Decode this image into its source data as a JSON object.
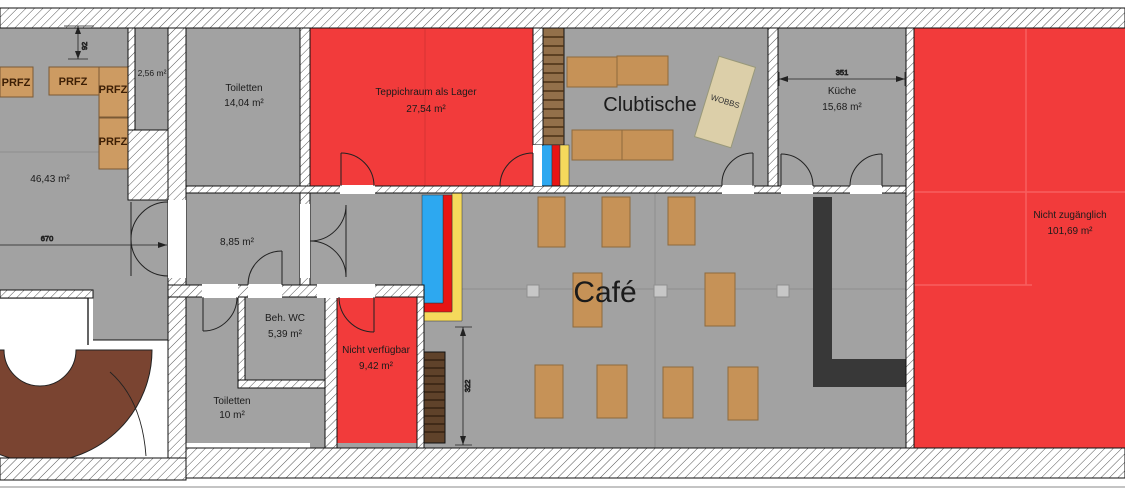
{
  "rooms": {
    "room_46": {
      "area": "46,43 m²"
    },
    "room_256": {
      "area": "2,56 m²"
    },
    "toiletten_top": {
      "name": "Toiletten",
      "area": "14,04 m²"
    },
    "teppichraum": {
      "name": "Teppichraum als Lager",
      "area": "27,54 m²"
    },
    "clubtische": {
      "name": "Clubtische"
    },
    "kueche": {
      "name": "Küche",
      "area": "15,68 m²"
    },
    "nicht_zugaenglich": {
      "name": "Nicht zugänglich",
      "area": "101,69 m²"
    },
    "room_885": {
      "area": "8,85 m²"
    },
    "beh_wc": {
      "name": "Beh. WC",
      "area": "5,39 m²"
    },
    "toiletten_bottom": {
      "name": "Toiletten",
      "area": "10 m²"
    },
    "nicht_verfuegbar": {
      "name": "Nicht verfügbar",
      "area": "9,42 m²"
    },
    "cafe": {
      "name": "Café"
    }
  },
  "furniture": {
    "prfz": "PRFZ",
    "wobbs": "WOBBS"
  },
  "dimensions": {
    "width_670": "670",
    "height_92": "92",
    "width_351": "351",
    "height_322": "322"
  },
  "colors": {
    "floor_gray": "#a2a2a2",
    "red_zone": "#f23b3b",
    "strip_blue": "#2da8f0",
    "strip_red": "#e81414",
    "strip_yellow": "#f5d95c",
    "wood_table": "#c69257",
    "bar_black": "#383838",
    "ramp_brown": "#7a4431"
  }
}
